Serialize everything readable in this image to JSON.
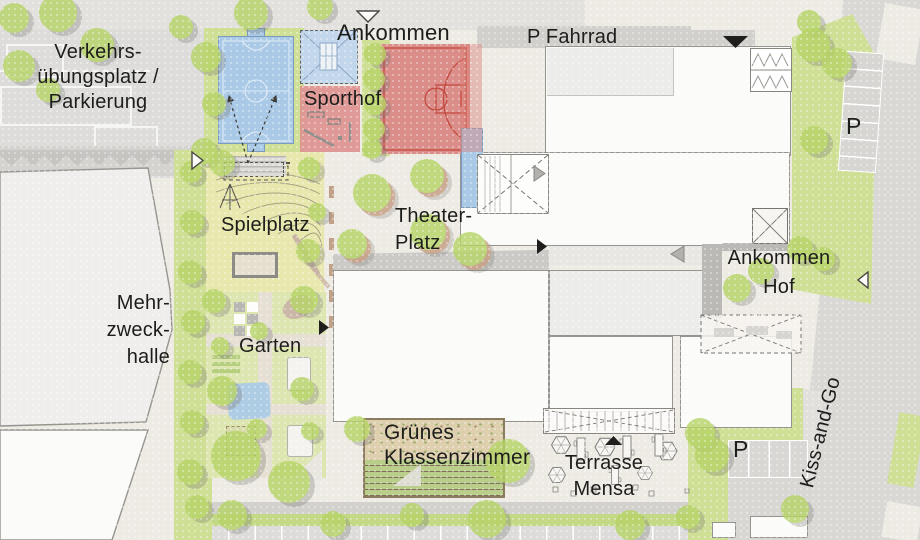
{
  "colors": {
    "paving": "#edebe4",
    "road": "#d9d8d5",
    "roadLight": "#e1e0dd",
    "parkingLot": "#dddcda",
    "sidewalk": "#e3e1dd",
    "building": "#fbfbf9",
    "buildingGray": "#ececea",
    "outline": "#96948e",
    "lawn": "#cfe096",
    "playground": "#e8e8ae",
    "gardenGreen": "#dde6b0",
    "hedge": "#c3d985",
    "tree": "#b7d468",
    "planter": "#c79e83",
    "courtBlue": "#a9c9e6",
    "courtBlueLine": "#eaf2f9",
    "blueBorder": "#7d9cbd",
    "courtRed": "#da8d89",
    "courtRedLine": "#c2463a",
    "sportRed": "#de9390",
    "sand": "#ded0ae",
    "pathGray": "#cbcac7",
    "wall": "#bbb9b5",
    "text": "#1d1d1b"
  },
  "labels": {
    "verkehrsuebungsplatz": [
      "Verkehrs-",
      "übungsplatz /",
      "Parkierung"
    ],
    "ankommen_nord": "Ankommen",
    "sporthof": "Sporthof",
    "p_fahrrad": "P Fahrrad",
    "spielplatz": "Spielplatz",
    "theater_platz": [
      "Theater-",
      "Platz"
    ],
    "mehrzweckhalle": [
      "Mehr-",
      "zweck-",
      "halle"
    ],
    "garten": "Garten",
    "ankommen_hof": [
      "Ankommen",
      "Hof"
    ],
    "gruenes_klassenzimmer": [
      "Grünes",
      "Klassenzimmer"
    ],
    "terrasse_mensa": [
      "Terrasse",
      "Mensa"
    ],
    "kiss_and_go": "Kiss-and-Go",
    "p_parkplatz_ost": "P",
    "p_parkplatz_sued": "P"
  },
  "markers": [
    {
      "name": "entrance-arrow-north",
      "dir": "down",
      "style": "outline",
      "x": 356,
      "y": 10,
      "w": 24,
      "h": 13
    },
    {
      "name": "entrance-arrow-west",
      "dir": "right",
      "style": "outline",
      "x": 191,
      "y": 151,
      "w": 13,
      "h": 19
    },
    {
      "name": "entrance-arrow-northeast",
      "dir": "down",
      "style": "filled",
      "x": 722,
      "y": 35,
      "w": 27,
      "h": 14
    },
    {
      "name": "entrance-arrow-theaterhof",
      "dir": "right",
      "style": "filled",
      "x": 536,
      "y": 238,
      "w": 12,
      "h": 17
    },
    {
      "name": "entrance-arrow-garten",
      "dir": "right",
      "style": "filled",
      "x": 318,
      "y": 319,
      "w": 12,
      "h": 17
    },
    {
      "name": "entrance-arrow-mensa",
      "dir": "up",
      "style": "filled",
      "x": 604,
      "y": 435,
      "w": 19,
      "h": 11
    },
    {
      "name": "entrance-arrow-hof",
      "dir": "left",
      "style": "outline",
      "x": 857,
      "y": 271,
      "w": 12,
      "h": 18
    },
    {
      "name": "walkway-arrow",
      "dir": "left",
      "style": "gray",
      "x": 670,
      "y": 245,
      "w": 15,
      "h": 18
    },
    {
      "name": "stair-arrow",
      "dir": "right",
      "style": "gray",
      "x": 533,
      "y": 165,
      "w": 13,
      "h": 17
    }
  ],
  "trees": [
    [
      14,
      18,
      15
    ],
    [
      58,
      13,
      19
    ],
    [
      97,
      45,
      17
    ],
    [
      19,
      66,
      16
    ],
    [
      48,
      90,
      12
    ],
    [
      181,
      27,
      12
    ],
    [
      206,
      57,
      15
    ],
    [
      214,
      104,
      12
    ],
    [
      204,
      151,
      13
    ],
    [
      251,
      13,
      17
    ],
    [
      320,
      7,
      13
    ],
    [
      375,
      54,
      11
    ],
    [
      374,
      79,
      11
    ],
    [
      375,
      104,
      11
    ],
    [
      374,
      129,
      11
    ],
    [
      372,
      149,
      10
    ],
    [
      809,
      22,
      12
    ],
    [
      813,
      45,
      17
    ],
    [
      837,
      63,
      15
    ],
    [
      814,
      140,
      14
    ],
    [
      800,
      249,
      13
    ],
    [
      823,
      259,
      12
    ],
    [
      737,
      288,
      14
    ],
    [
      761,
      271,
      13
    ],
    [
      372,
      193,
      19,
      "p"
    ],
    [
      427,
      176,
      17,
      "p"
    ],
    [
      352,
      244,
      15,
      "p"
    ],
    [
      428,
      232,
      18,
      "p"
    ],
    [
      470,
      249,
      17,
      "p"
    ],
    [
      222,
      163,
      13
    ],
    [
      309,
      168,
      11
    ],
    [
      317,
      212,
      9
    ],
    [
      308,
      251,
      12
    ],
    [
      214,
      301,
      12
    ],
    [
      304,
      300,
      14
    ],
    [
      220,
      346,
      9
    ],
    [
      259,
      331,
      9
    ],
    [
      222,
      391,
      15
    ],
    [
      302,
      389,
      12
    ],
    [
      257,
      429,
      10
    ],
    [
      236,
      456,
      25
    ],
    [
      289,
      482,
      21
    ],
    [
      310,
      431,
      9
    ],
    [
      191,
      172,
      11
    ],
    [
      192,
      222,
      12
    ],
    [
      190,
      272,
      12
    ],
    [
      193,
      322,
      12
    ],
    [
      190,
      372,
      12
    ],
    [
      192,
      422,
      12
    ],
    [
      190,
      472,
      13
    ],
    [
      197,
      507,
      12
    ],
    [
      232,
      515,
      15
    ],
    [
      333,
      524,
      13
    ],
    [
      412,
      515,
      12
    ],
    [
      487,
      519,
      19
    ],
    [
      630,
      525,
      15
    ],
    [
      688,
      517,
      12
    ],
    [
      357,
      429,
      13
    ],
    [
      508,
      461,
      22
    ],
    [
      700,
      433,
      15
    ],
    [
      712,
      455,
      17
    ],
    [
      795,
      509,
      14
    ]
  ]
}
